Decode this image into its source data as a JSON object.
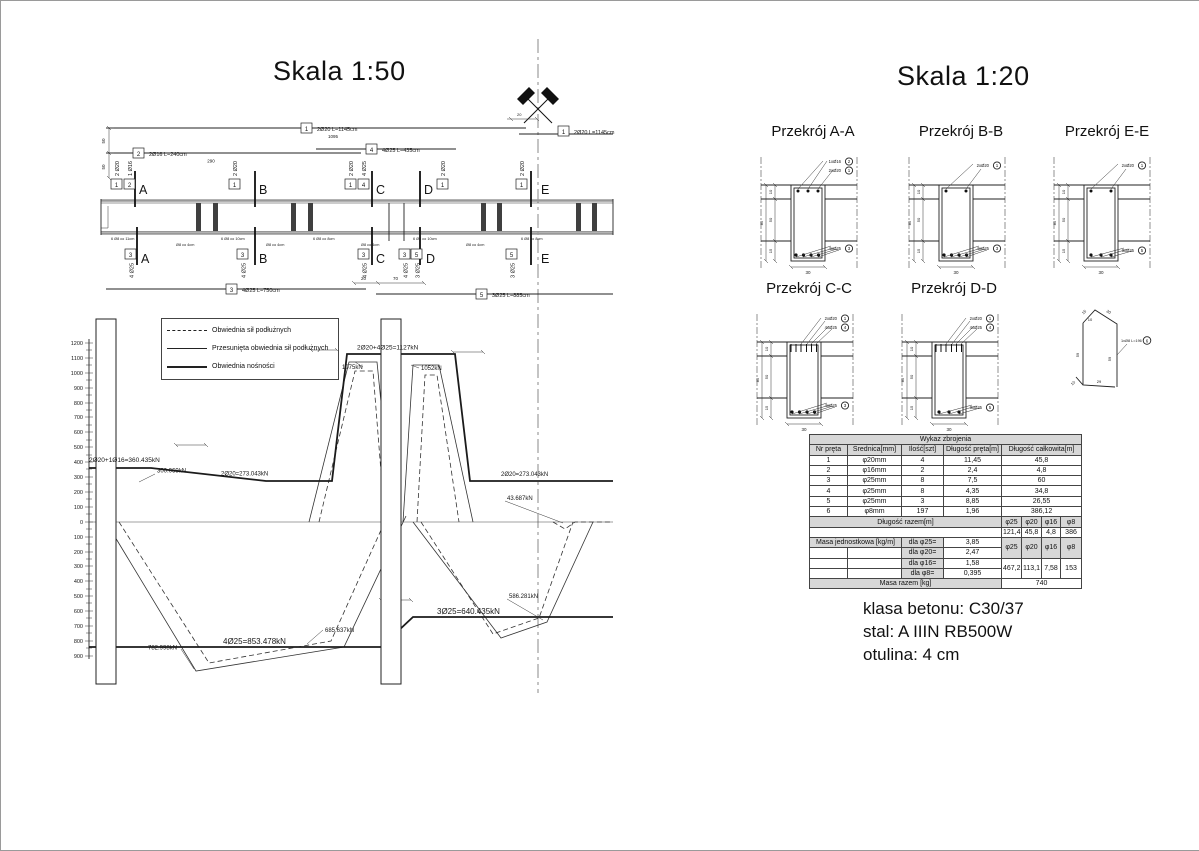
{
  "titles": {
    "left": "Skala 1:50",
    "right": "Skala 1:20"
  },
  "elevation": {
    "callout_labels": {
      "c1": "2Ø20 L=1145cm",
      "c2": "2Ø16 L=240cm",
      "c3": "4Ø25 L=750cm",
      "c4": "4Ø25 L=435cm",
      "c5": "3Ø25 L=885cm"
    },
    "callout_nums": {
      "n1": "1",
      "n2": "2",
      "n3": "3",
      "n4": "4",
      "n5": "5"
    },
    "dims": {
      "d1095": "1095",
      "d290": "290",
      "d50": "50",
      "d20": "20",
      "d70": "70"
    },
    "section_letters": {
      "A": "A",
      "B": "B",
      "C": "C",
      "D": "D",
      "E": "E"
    },
    "bar_labels": {
      "b2o20": "2 Ø20",
      "b1o16": "1 Ø16",
      "b4o25": "4 Ø25",
      "b3o25": "3 Ø25"
    },
    "stirrups": [
      "6 Ø8 co 11cm",
      "Ø8 co 4cm",
      "6 Ø8 co 10cm",
      "Ø8 co 4cm",
      "6 Ø8 co 8cm",
      "Ø8 co 4cm",
      "6 Ø8 co 10cm",
      "Ø8 co 4cm",
      "6 Ø8 co 8cm"
    ]
  },
  "chart_data": {
    "type": "line",
    "title": "",
    "xlabel": "",
    "ylabel": "kN",
    "ylim": [
      -900,
      1200
    ],
    "grid": false,
    "legend_position": "top-left",
    "legend": [
      "Obwiednia sił podłużnych",
      "Przesunięta obwiednia sił podłużnych",
      "Obwiednia nośności"
    ],
    "ytick_labels": [
      "1200",
      "1100",
      "1000",
      "900",
      "800",
      "700",
      "600",
      "500",
      "400",
      "300",
      "200",
      "100",
      "0",
      "100",
      "200",
      "300",
      "400",
      "500",
      "600",
      "700",
      "800",
      "900"
    ],
    "series": [
      {
        "name": "Obwiednia nośności — pas górny",
        "values_kN": [
          360.435,
          273.043,
          1127,
          273.043
        ]
      },
      {
        "name": "Obwiednia nośności — pas dolny",
        "values_kN": [
          -853.478,
          -640.435
        ]
      },
      {
        "name": "Wartości pośrednie",
        "values_kN": [
          300.069,
          1075,
          1052,
          43.687,
          -586.281,
          -685.637,
          -782.998
        ]
      }
    ],
    "annotations": [
      "2Ø20+1Ø16=360.435kN",
      "300.069kN",
      "2Ø20=273.043kN",
      "2Ø20+4Ø25=1127kN",
      "1075kN",
      "1052kN",
      "2Ø20=273.043kN",
      "43.687kN",
      "586.281kN",
      "3Ø25=640.435kN",
      "685.637kN",
      "782.998kN",
      "4Ø25=853.478kN"
    ]
  },
  "sections": {
    "a_title": "Przekrój A-A",
    "b_title": "Przekrój B-B",
    "e_title": "Przekrój E-E",
    "c_title": "Przekrój C-C",
    "d_title": "Przekrój D-D",
    "labels": {
      "l2o20": "2xØ20",
      "l1o16": "1xØ16",
      "l4o25": "4xØ25",
      "l3o25": "3xØ25"
    },
    "nums": {
      "n1": "1",
      "n2": "2",
      "n3": "3",
      "n4": "4",
      "n5": "5",
      "n6": "6"
    },
    "dims": {
      "h10": "10",
      "h50": "50",
      "h15": "15",
      "h85": "85",
      "w30": "30"
    },
    "stirrup": {
      "label": "1xØ8 L=196",
      "d10": "10",
      "d15": "15",
      "d20": "20",
      "d59": "59",
      "d29": "29"
    }
  },
  "table": {
    "title": "Wykaz zbrojenia",
    "headers": [
      "Nr pręta",
      "Średnica[mm]",
      "Ilość[szt]",
      "Długość pręta[m]",
      "Długość całkowita[m]"
    ],
    "rows": [
      [
        "1",
        "φ20mm",
        "4",
        "11,45",
        "45,8"
      ],
      [
        "2",
        "φ16mm",
        "2",
        "2,4",
        "4,8"
      ],
      [
        "3",
        "φ25mm",
        "8",
        "7,5",
        "60"
      ],
      [
        "4",
        "φ25mm",
        "8",
        "4,35",
        "34,8"
      ],
      [
        "5",
        "φ25mm",
        "3",
        "8,85",
        "26,55"
      ],
      [
        "6",
        "φ8mm",
        "197",
        "1,96",
        "386,12"
      ]
    ],
    "total_length_label": "Długość razem[m]",
    "dia_headers": [
      "φ25",
      "φ20",
      "φ16",
      "φ8"
    ],
    "total_lengths": [
      "121,4",
      "45,8",
      "4,8",
      "386"
    ],
    "unit_mass_label": "Masa jednostkowa [kg/m]",
    "unit_mass_rows": [
      [
        "dla φ25=",
        "3,85"
      ],
      [
        "dla φ20=",
        "2,47"
      ],
      [
        "dla φ16=",
        "1,58"
      ],
      [
        "dla φ8=",
        "0,395"
      ]
    ],
    "masses": [
      "467,2",
      "113,1",
      "7,58",
      "153"
    ],
    "total_mass_label": "Masa razem [kg]",
    "total_mass": "740"
  },
  "notes": [
    "klasa betonu: C30/37",
    "stal: A IIIN RB500W",
    "otulina: 4 cm"
  ]
}
